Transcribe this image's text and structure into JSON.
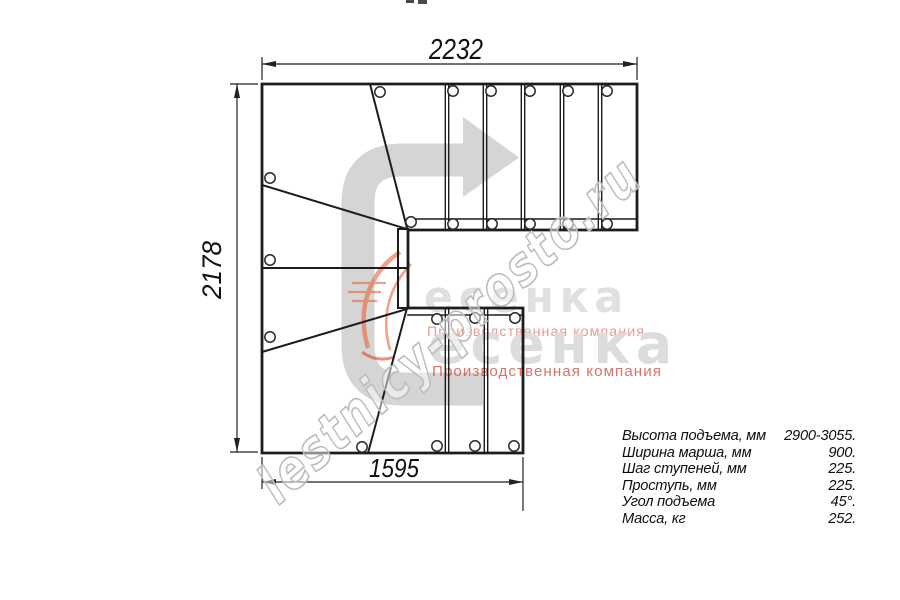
{
  "dims": {
    "top": "2232",
    "left": "2178",
    "bottom": "1595"
  },
  "specs": {
    "rows": [
      {
        "label": "Высота подъема, мм",
        "value": "2900-3055."
      },
      {
        "label": "Ширина марша, мм",
        "value": "900."
      },
      {
        "label": "Шаг ступеней, мм",
        "value": "225."
      },
      {
        "label": "Проступь, мм",
        "value": "225."
      },
      {
        "label": "Угол подъема",
        "value": "45°."
      },
      {
        "label": "Масса, кг",
        "value": "252."
      }
    ]
  },
  "watermark": {
    "site": "lestnicy-prosto.ru",
    "logo_text": "есенка",
    "tagline": "Производственная компания"
  },
  "colors": {
    "line": "#1c1c1c",
    "arrow": "#d5d5d5",
    "watermark_stroke": "#bdbdbd",
    "logo_gray": "#d7d7d7",
    "tagline_pink": "#e2837a",
    "tagline_red": "#cc5244",
    "swoosh_orange": "#e8643a"
  }
}
